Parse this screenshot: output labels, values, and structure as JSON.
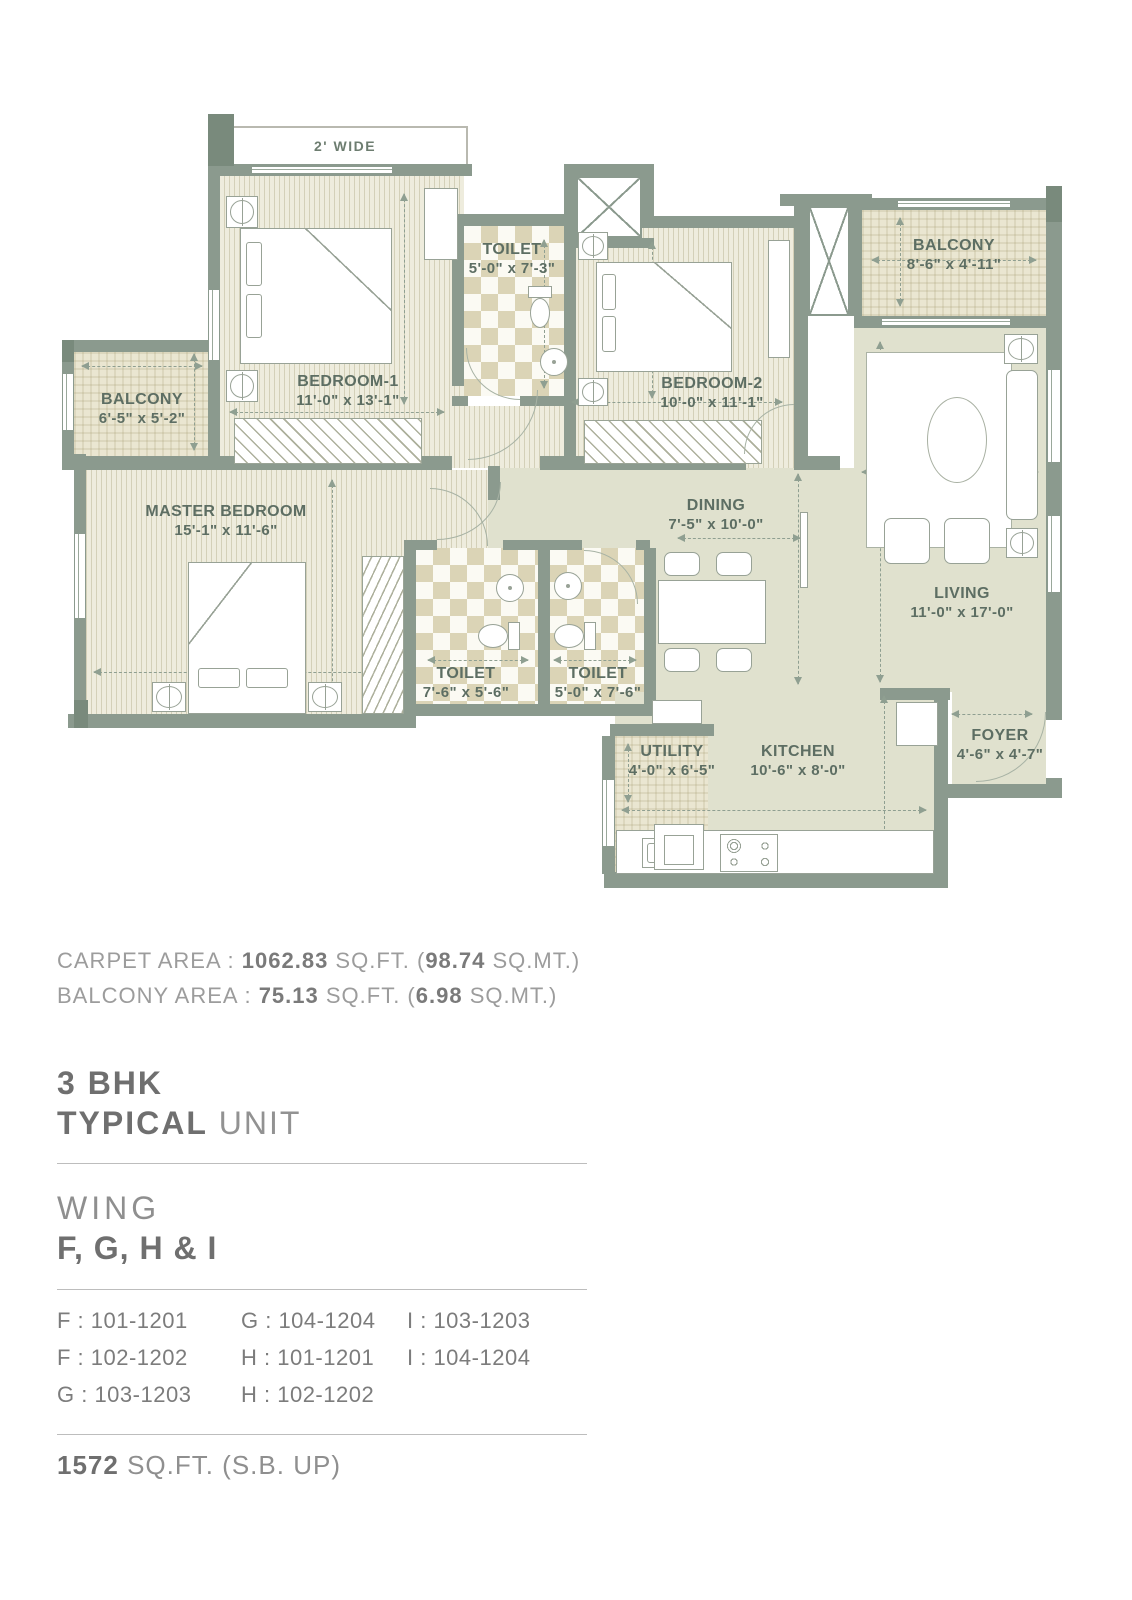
{
  "plan": {
    "ledge": "2' WIDE",
    "rooms": {
      "bedroom1": {
        "name": "BEDROOM-1",
        "dims": "11'-0\" x 13'-1\""
      },
      "toilet_top": {
        "name": "TOILET",
        "dims": "5'-0\" x 7'-3\""
      },
      "bedroom2": {
        "name": "BEDROOM-2",
        "dims": "10'-0\" x 11'-1\""
      },
      "balcony_ne": {
        "name": "BALCONY",
        "dims": "8'-6\" x 4'-11\""
      },
      "balcony_w": {
        "name": "BALCONY",
        "dims": "6'-5\" x 5'-2\""
      },
      "master": {
        "name": "MASTER BEDROOM",
        "dims": "15'-1\" x 11'-6\""
      },
      "dining": {
        "name": "DINING",
        "dims": "7'-5\" x 10'-0\""
      },
      "living": {
        "name": "LIVING",
        "dims": "11'-0\" x 17'-0\""
      },
      "toilet_master": {
        "name": "TOILET",
        "dims": "7'-6\" x 5'-6\""
      },
      "toilet_common": {
        "name": "TOILET",
        "dims": "5'-0\" x 7'-6\""
      },
      "utility": {
        "name": "UTILITY",
        "dims": "4'-0\" x 6'-5\""
      },
      "kitchen": {
        "name": "KITCHEN",
        "dims": "10'-6\" x 8'-0\""
      },
      "foyer": {
        "name": "FOYER",
        "dims": "4'-6\" x 4'-7\""
      }
    }
  },
  "areas": {
    "carpet": [
      "CARPET AREA : ",
      "1062.83",
      " SQ.FT. (",
      "98.74",
      " SQ.MT.)"
    ],
    "balcony": [
      "BALCONY AREA : ",
      "75.13",
      " SQ.FT. (",
      "6.98",
      " SQ.MT.)"
    ]
  },
  "title": {
    "line1": "3 BHK",
    "line2_bold": "TYPICAL",
    "line2_light": " UNIT"
  },
  "wing": {
    "label": "WING",
    "value": "F, G, H & I"
  },
  "units": [
    "F : 101-1201",
    "G : 104-1204",
    "I : 103-1203",
    "F : 102-1202",
    "H : 101-1201",
    "I : 104-1204",
    "G : 103-1203",
    "H : 102-1202"
  ],
  "footer": {
    "value": "1572",
    "suffix": " SQ.FT. (S.B. UP)"
  },
  "palette": {
    "wall": "#8b9a8e",
    "room_floor": "#eeecdd",
    "open_floor": "#e0e1ce",
    "tile": "#dbd4b6",
    "balcony_floor": "#e9e5d1",
    "label_text": "#5d6e63",
    "info_text": "#9c9c9c",
    "info_bold": "#757575"
  }
}
